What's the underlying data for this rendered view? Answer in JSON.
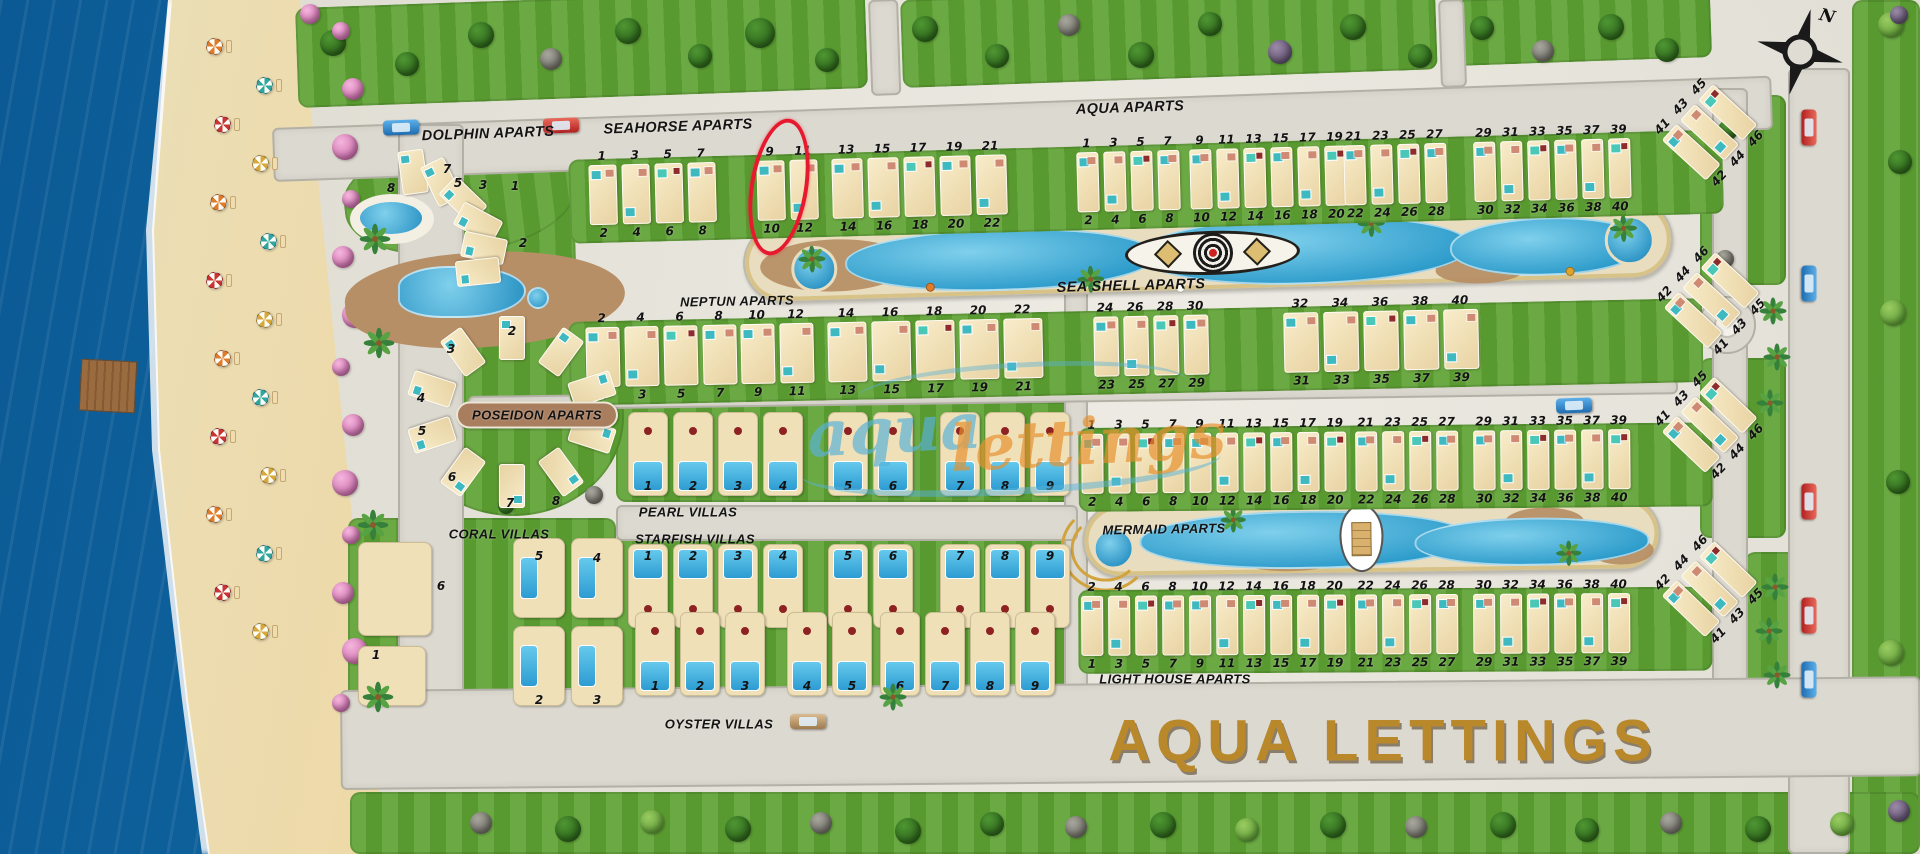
{
  "title": "Aqua Lettings resort site map",
  "logo": {
    "text": "AQUA LETTINGS",
    "color": "#b9882b"
  },
  "watermark": {
    "word1": "aqua",
    "word2": "lettings"
  },
  "compass": {
    "north_label": "N"
  },
  "highlight": {
    "circled_units": [
      "9",
      "10"
    ],
    "color": "#e6192e",
    "location": "Seahorse Aparts row"
  },
  "labels": {
    "dolphin": "DOLPHIN APARTS",
    "seahorse": "SEAHORSE APARTS",
    "aqua": "AQUA APARTS",
    "seashell": "SEA SHELL APARTS",
    "neptun": "NEPTUN APARTS",
    "poseidon": "POSEIDON APARTS",
    "pearl": "PEARL VILLAS",
    "coral": "CORAL VILLAS",
    "starfish": "STARFISH VILLAS",
    "mermaid": "MERMAID APARTS",
    "oyster": "OYSTER VILLAS",
    "lighthouse": "LIGHT HOUSE APARTS"
  },
  "apartment_rows": [
    {
      "id": "row-a",
      "clusters": [
        {
          "top": [
            "1",
            "3",
            "5",
            "7"
          ],
          "bottom": [
            "2",
            "4",
            "6",
            "8"
          ]
        },
        {
          "top": [
            "9",
            "11"
          ],
          "bottom": [
            "10",
            "12"
          ]
        },
        {
          "top": [
            "13",
            "15",
            "17",
            "19",
            "21"
          ],
          "bottom": [
            "14",
            "16",
            "18",
            "20",
            "22"
          ]
        },
        {
          "top": [
            "1",
            "3",
            "5",
            "7"
          ],
          "bottom": [
            "2",
            "4",
            "6",
            "8"
          ]
        },
        {
          "top": [
            "9",
            "11",
            "13",
            "15",
            "17",
            "19"
          ],
          "bottom": [
            "10",
            "12",
            "14",
            "16",
            "18",
            "20"
          ]
        },
        {
          "top": [
            "21",
            "23",
            "25",
            "27"
          ],
          "bottom": [
            "22",
            "24",
            "26",
            "28"
          ]
        },
        {
          "top": [
            "29",
            "31",
            "33",
            "35",
            "37",
            "39"
          ],
          "bottom": [
            "30",
            "32",
            "34",
            "36",
            "38",
            "40"
          ]
        },
        {
          "top": [
            "41",
            "43",
            "45"
          ],
          "bottom": [
            "42",
            "44",
            "46"
          ]
        }
      ]
    },
    {
      "id": "row-c",
      "clusters": [
        {
          "top": [
            "2",
            "4",
            "6",
            "8"
          ],
          "bottom": [
            "1",
            "3",
            "5",
            "7"
          ]
        },
        {
          "top": [
            "10",
            "12"
          ],
          "bottom": [
            "9",
            "11"
          ]
        },
        {
          "top": [
            "14",
            "16",
            "18",
            "20",
            "22"
          ],
          "bottom": [
            "13",
            "15",
            "17",
            "19",
            "21"
          ]
        },
        {
          "top": [
            "24",
            "26",
            "28",
            "30"
          ],
          "bottom": [
            "23",
            "25",
            "27",
            "29"
          ]
        },
        {
          "top": [
            "32",
            "34",
            "36",
            "38",
            "40"
          ],
          "bottom": [
            "31",
            "33",
            "35",
            "37",
            "39"
          ]
        },
        {
          "top": [
            "42",
            "44",
            "46"
          ],
          "bottom": [
            "41",
            "43",
            "45"
          ]
        }
      ]
    },
    {
      "id": "row-d",
      "clusters": [
        {
          "top": [
            "1",
            "3",
            "5",
            "7"
          ],
          "bottom": [
            "2",
            "4",
            "6",
            "8"
          ]
        },
        {
          "top": [
            "9",
            "11",
            "13",
            "15",
            "17",
            "19"
          ],
          "bottom": [
            "10",
            "12",
            "14",
            "16",
            "18",
            "20"
          ]
        },
        {
          "top": [
            "21",
            "23",
            "25",
            "27"
          ],
          "bottom": [
            "22",
            "24",
            "26",
            "28"
          ]
        },
        {
          "top": [
            "29",
            "31",
            "33",
            "35",
            "37",
            "39"
          ],
          "bottom": [
            "30",
            "32",
            "34",
            "36",
            "38",
            "40"
          ]
        },
        {
          "top": [
            "41",
            "43",
            "45"
          ],
          "bottom": [
            "42",
            "44",
            "46"
          ]
        }
      ]
    },
    {
      "id": "row-e",
      "clusters": [
        {
          "top": [
            "2",
            "4",
            "6",
            "8"
          ],
          "bottom": [
            "1",
            "3",
            "5",
            "7"
          ]
        },
        {
          "top": [
            "10",
            "12",
            "14",
            "16",
            "18",
            "20"
          ],
          "bottom": [
            "9",
            "11",
            "13",
            "15",
            "17",
            "19"
          ]
        },
        {
          "top": [
            "22",
            "24",
            "26",
            "28"
          ],
          "bottom": [
            "21",
            "23",
            "25",
            "27"
          ]
        },
        {
          "top": [
            "30",
            "32",
            "34",
            "36",
            "38",
            "40"
          ],
          "bottom": [
            "29",
            "31",
            "33",
            "35",
            "37",
            "39"
          ]
        },
        {
          "top": [
            "42",
            "44",
            "46"
          ],
          "bottom": [
            "41",
            "43",
            "45"
          ]
        }
      ]
    }
  ],
  "villa_rows": [
    {
      "id": "pearl",
      "groups": [
        [
          "1",
          "2",
          "3",
          "4"
        ],
        [
          "5",
          "6"
        ],
        [
          "7",
          "8",
          "9"
        ]
      ]
    },
    {
      "id": "starfish",
      "groups": [
        [
          "1",
          "2",
          "3",
          "4"
        ],
        [
          "5",
          "6"
        ],
        [
          "7",
          "8",
          "9"
        ]
      ]
    },
    {
      "id": "oyster",
      "groups": [
        [
          "1",
          "2",
          "3"
        ],
        [
          "4",
          "5"
        ],
        [
          "6",
          "7",
          "8",
          "9"
        ]
      ]
    }
  ],
  "coral_numbers": [
    "6",
    "5",
    "4",
    "1",
    "2",
    "3"
  ],
  "dolphin_numbers": [
    "8",
    "7",
    "5",
    "3",
    "1",
    "2"
  ],
  "poseidon_numbers": [
    "2",
    "3",
    "4",
    "5",
    "6",
    "7",
    "8"
  ],
  "cars": [
    {
      "color": "blue"
    },
    {
      "color": "red"
    },
    {
      "color": "red"
    },
    {
      "color": "blue"
    },
    {
      "color": "red"
    },
    {
      "color": "red"
    },
    {
      "color": "blue"
    },
    {
      "color": "blue"
    },
    {
      "color": "tan"
    }
  ]
}
